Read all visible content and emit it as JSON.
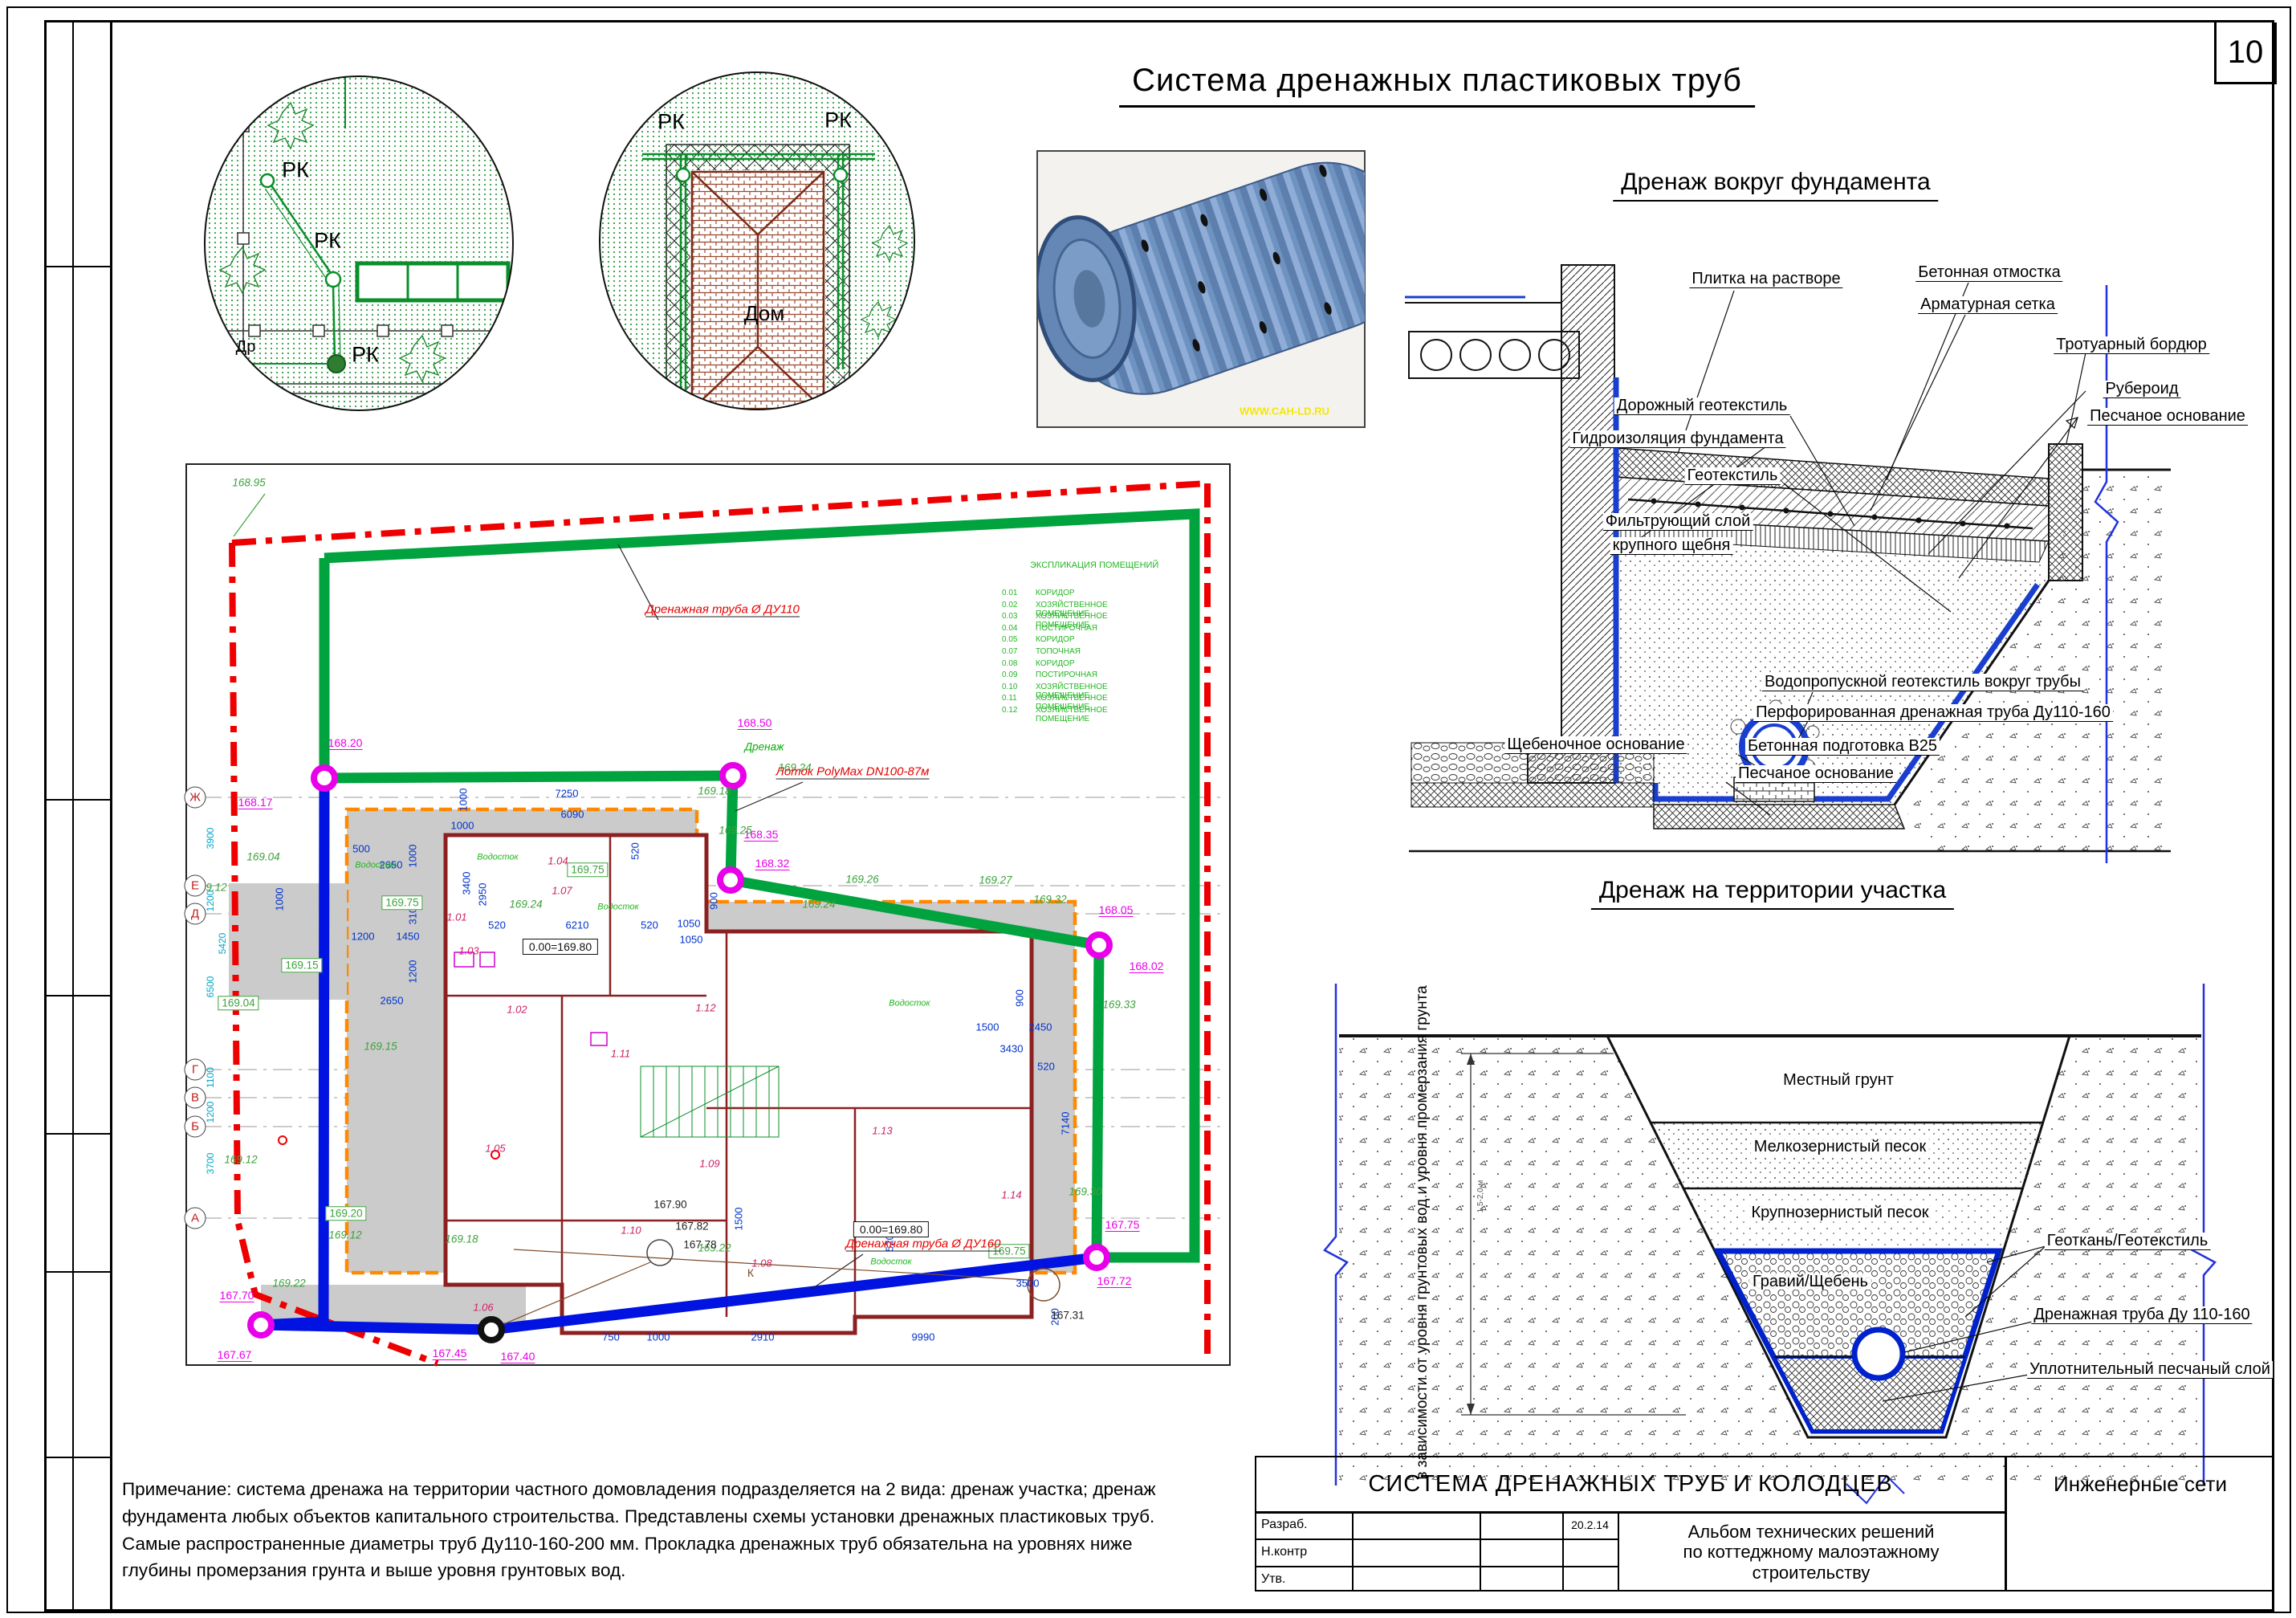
{
  "sheet": {
    "number": "10",
    "main_title": "Система дренажных пластиковых труб"
  },
  "headings": {
    "foundation": "Дренаж вокруг фундамента",
    "territory": "Дренаж на территории участка"
  },
  "note": "Примечание: система дренажа на территории частного домовладения подразделяется на 2 вида: дренаж участка; дренаж\nфундамента любых объектов капитального строительства. Представлены схемы установки дренажных пластиковых труб.\nСамые распространенные диаметры труб Ду110-160-200 мм. Прокладка дренажных труб обязательна на уровнях ниже\nглубины промерзания грунта и выше уровня грунтовых вод.",
  "titleblock": {
    "title": "СИСТЕМА ДРЕНАЖНЫХ ТРУБ И КОЛОДЦЕВ",
    "right": "Инженерные сети",
    "album": [
      "Альбом технических решений",
      "по коттеджному малоэтажному",
      "строительству"
    ],
    "date": "20.2.14",
    "rows": [
      "Разраб.",
      "Н.контр",
      "Утв."
    ]
  },
  "photo": {
    "watermark": "WWW.CAH-LD.RU"
  },
  "details": {
    "rk": "РК",
    "dr": "Др",
    "house": "Дом",
    "rk_positions": [
      [
        368,
        212
      ],
      [
        408,
        300
      ],
      [
        455,
        442
      ],
      [
        836,
        152
      ],
      [
        1044,
        150
      ]
    ],
    "dr_position": [
      306,
      432
    ],
    "house_position": [
      952,
      390
    ]
  },
  "foundation": {
    "labels": [
      [
        "Плитка на растворе",
        2200,
        348
      ],
      [
        "Бетонная отмостка",
        2478,
        340
      ],
      [
        "Арматурная сетка",
        2476,
        380
      ],
      [
        "Тротуарный бордюр",
        2655,
        430
      ],
      [
        "Рубероид",
        2668,
        485
      ],
      [
        "Песчаное основание",
        2700,
        519
      ],
      [
        "Дорожный геотекстиль",
        2120,
        506
      ],
      [
        "Гидроизоляция фундамента",
        2090,
        547
      ],
      [
        "Геотекстиль",
        2158,
        593
      ],
      [
        "Фильтрующий слой",
        2090,
        650
      ],
      [
        "крупного щебня",
        2082,
        680
      ],
      [
        "Водопропускной геотекстиль вокруг трубы",
        2395,
        850
      ],
      [
        "Перфорированная дренажная труба Ду110-160",
        2408,
        888
      ],
      [
        "Бетонная подготовка В25",
        2295,
        930
      ],
      [
        "Песчаное основание",
        2262,
        964
      ],
      [
        "Щебеночное основание",
        1988,
        928
      ]
    ]
  },
  "trench": {
    "side_note": "в зависимости от уровня\nгрунтовых вод и уровня\nпромерзания грунта",
    "depth": "1,5-2,0 м",
    "layers": [
      [
        "Местный грунт",
        2290,
        1345
      ],
      [
        "Мелкозернистый песок",
        2292,
        1428
      ],
      [
        "Крупнозернистый песок",
        2292,
        1510
      ],
      [
        "Гравий/Щебень",
        2255,
        1596
      ]
    ],
    "labels": [
      [
        "Геоткань/Геотекстиль",
        2650,
        1546
      ],
      [
        "Дренажная труба Ду 110-160",
        2668,
        1638
      ],
      [
        "Уплотнительный песчаный слой",
        2678,
        1706
      ]
    ]
  },
  "plan": {
    "red_pipe110": "Дренажная труба Ø ДУ110",
    "red_pipe160": "Дренажная труба Ø ДУ160",
    "lotok": "Лоток PolyMax DN100-87м",
    "drain_word": "Дренаж",
    "k": "К",
    "explication": {
      "title": "ЭКСПЛИКАЦИЯ ПОМЕЩЕНИЙ",
      "rows": [
        [
          "0.01",
          "КОРИДОР"
        ],
        [
          "0.02",
          "ХОЗЯЙСТВЕННОЕ ПОМЕЩЕНИЕ"
        ],
        [
          "0.03",
          "ХОЗЯЙСТВЕННОЕ ПОМЕЩЕНИЕ"
        ],
        [
          "0.04",
          "ПОСТИРОЧНАЯ"
        ],
        [
          "0.05",
          "КОРИДОР"
        ],
        [
          "0.07",
          "ТОПОЧНАЯ"
        ],
        [
          "0.08",
          "КОРИДОР"
        ],
        [
          "0.09",
          "ПОСТИРОЧНАЯ"
        ],
        [
          "0.10",
          "ХОЗЯЙСТВЕННОЕ ПОМЕЩЕНИЕ"
        ],
        [
          "0.11",
          "ХОЗЯЙСТВЕННОЕ ПОМЕЩЕНИЕ"
        ],
        [
          "0.12",
          "ХОЗЯЙСТВЕННОЕ ПОМЕЩЕНИЕ"
        ]
      ]
    },
    "axes": [
      [
        "Ж",
        993
      ],
      [
        "Е",
        1103
      ],
      [
        "Д",
        1138
      ],
      [
        "Г",
        1332
      ],
      [
        "В",
        1367
      ],
      [
        "Б",
        1403
      ],
      [
        "А",
        1517
      ]
    ],
    "cyan_dims": [
      [
        "3900",
        262,
        1044
      ],
      [
        "1200",
        262,
        1122
      ],
      [
        "5420",
        277,
        1175
      ],
      [
        "6500",
        262,
        1229
      ],
      [
        "1100",
        262,
        1342
      ],
      [
        "1200",
        262,
        1385
      ],
      [
        "3700",
        262,
        1449
      ]
    ],
    "magenta": [
      [
        "168.20",
        430,
        926
      ],
      [
        "168.17",
        318,
        1000
      ],
      [
        "168.50",
        940,
        901
      ],
      [
        "168.35",
        948,
        1040
      ],
      [
        "168.32",
        962,
        1076
      ],
      [
        "168.05",
        1390,
        1134
      ],
      [
        "168.02",
        1428,
        1204
      ],
      [
        "167.75",
        1398,
        1526
      ],
      [
        "167.72",
        1388,
        1596
      ],
      [
        "167.70",
        295,
        1614
      ],
      [
        "167.67",
        292,
        1688
      ],
      [
        "167.45",
        560,
        1686
      ],
      [
        "167.40",
        645,
        1690
      ]
    ],
    "green": [
      [
        "168.95",
        310,
        601
      ],
      [
        "169.04",
        328,
        1067
      ],
      [
        "169.12",
        262,
        1105
      ],
      [
        "169.18",
        890,
        985
      ],
      [
        "169.25",
        916,
        1034
      ],
      [
        "169.24",
        990,
        956
      ],
      [
        "169.26",
        1074,
        1095
      ],
      [
        "169.24",
        1020,
        1126
      ],
      [
        "169.27",
        1240,
        1096
      ],
      [
        "169.32",
        1308,
        1120
      ],
      [
        "169.33",
        1394,
        1251
      ],
      [
        "169.30",
        1352,
        1484
      ],
      [
        "169.22",
        360,
        1598
      ],
      [
        "169.22",
        890,
        1554
      ],
      [
        "169.12",
        300,
        1444
      ],
      [
        "169.12",
        430,
        1538
      ],
      [
        "169.18",
        575,
        1543
      ],
      [
        "169.15",
        474,
        1303
      ],
      [
        "169.24",
        655,
        1126
      ],
      [
        "Дренаж",
        952,
        930
      ]
    ],
    "green_boxed": [
      [
        "169.15",
        376,
        1202
      ],
      [
        "169.04",
        297,
        1249
      ],
      [
        "169.20",
        431,
        1511
      ],
      [
        "169.75",
        732,
        1083
      ],
      [
        "169.75",
        501,
        1124
      ],
      [
        "169.75",
        1257,
        1558
      ]
    ],
    "levels": [
      [
        "0.00=169.80",
        698,
        1179
      ],
      [
        "0.00=169.80",
        1110,
        1531
      ]
    ],
    "black": [
      [
        "167.90",
        835,
        1500
      ],
      [
        "167.82",
        862,
        1527
      ],
      [
        "167.78",
        872,
        1550
      ],
      [
        "167.31",
        1330,
        1638
      ]
    ],
    "rooms": [
      [
        "1.01",
        569,
        1142
      ],
      [
        "1.02",
        644,
        1257
      ],
      [
        "1.03",
        584,
        1184
      ],
      [
        "1.04",
        695,
        1072
      ],
      [
        "1.05",
        617,
        1430
      ],
      [
        "1.06",
        602,
        1628
      ],
      [
        "1.07",
        700,
        1109
      ],
      [
        "1.08",
        949,
        1573
      ],
      [
        "1.09",
        884,
        1449
      ],
      [
        "1.10",
        786,
        1532
      ],
      [
        "1.11",
        773,
        1312
      ],
      [
        "1.12",
        879,
        1255
      ],
      [
        "1.13",
        1099,
        1408
      ],
      [
        "1.14",
        1260,
        1488
      ]
    ],
    "dims": [
      [
        "7250",
        706,
        988
      ],
      [
        "6090",
        713,
        1014
      ],
      [
        "1000",
        577,
        996,
        1
      ],
      [
        "520",
        791,
        1060,
        1
      ],
      [
        "500",
        450,
        1057
      ],
      [
        "2650",
        487,
        1077
      ],
      [
        "1000",
        514,
        1066,
        1
      ],
      [
        "1000",
        576,
        1028
      ],
      [
        "3400",
        581,
        1100,
        1
      ],
      [
        "2950",
        601,
        1114,
        1
      ],
      [
        "520",
        619,
        1152
      ],
      [
        "6210",
        719,
        1152
      ],
      [
        "520",
        809,
        1152
      ],
      [
        "1050",
        858,
        1150
      ],
      [
        "1050",
        861,
        1170
      ],
      [
        "900",
        889,
        1122,
        1
      ],
      [
        "1200",
        452,
        1166
      ],
      [
        "1450",
        508,
        1166
      ],
      [
        "3100",
        514,
        1137,
        1
      ],
      [
        "1200",
        514,
        1210,
        1
      ],
      [
        "2650",
        488,
        1246
      ],
      [
        "900",
        1270,
        1243,
        1
      ],
      [
        "1500",
        1230,
        1279
      ],
      [
        "2450",
        1296,
        1279
      ],
      [
        "3430",
        1260,
        1306
      ],
      [
        "520",
        1303,
        1328
      ],
      [
        "7140",
        1327,
        1399,
        1
      ],
      [
        "3500",
        1280,
        1598
      ],
      [
        "200",
        1314,
        1640,
        1
      ],
      [
        "750",
        761,
        1665
      ],
      [
        "1000",
        820,
        1665
      ],
      [
        "2910",
        950,
        1665
      ],
      [
        "9990",
        1150,
        1665
      ],
      [
        "1000",
        348,
        1120,
        1
      ],
      [
        "520",
        1108,
        1548,
        1
      ],
      [
        "1500",
        920,
        1518,
        1
      ]
    ],
    "vodostok": {
      "t": "Водосток",
      "pos": [
        [
          620,
          1068
        ],
        [
          770,
          1130
        ],
        [
          1133,
          1250
        ],
        [
          1110,
          1572
        ],
        [
          468,
          1078
        ]
      ]
    }
  }
}
